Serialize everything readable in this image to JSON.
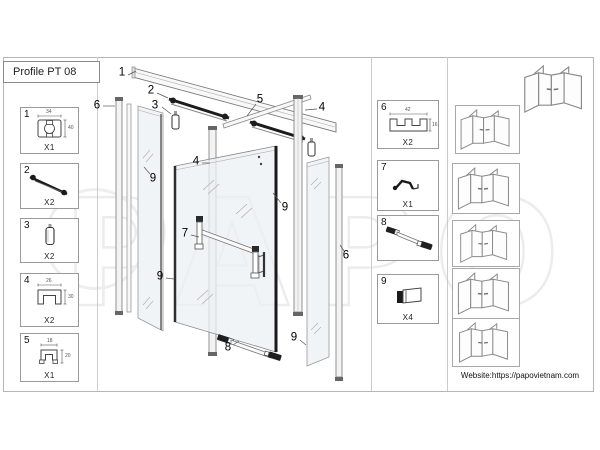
{
  "title": "Profile PT 08",
  "website": "Website:https://papovietnam.com",
  "watermark": "PAPO",
  "left_parts": [
    {
      "num": "1",
      "qty": "X1",
      "dim_top": "34",
      "dim_side": "40"
    },
    {
      "num": "2",
      "qty": "X2"
    },
    {
      "num": "3",
      "qty": "X2"
    },
    {
      "num": "4",
      "qty": "X2",
      "dim_top": "26",
      "dim_side": "30"
    },
    {
      "num": "5",
      "qty": "X1",
      "dim_top": "18",
      "dim_side": "20"
    }
  ],
  "right_parts": [
    {
      "num": "6",
      "qty": "X2",
      "dim_top": "42",
      "dim_side": "16"
    },
    {
      "num": "7",
      "qty": "X1"
    },
    {
      "num": "8",
      "qty": ""
    },
    {
      "num": "9",
      "qty": "X4"
    }
  ],
  "callouts": [
    {
      "label": "1"
    },
    {
      "label": "2"
    },
    {
      "label": "3"
    },
    {
      "label": "6"
    },
    {
      "label": "5"
    },
    {
      "label": "4"
    },
    {
      "label": "4"
    },
    {
      "label": "9"
    },
    {
      "label": "9"
    },
    {
      "label": "7"
    },
    {
      "label": "9"
    },
    {
      "label": "8"
    },
    {
      "label": "9"
    },
    {
      "label": "6"
    }
  ]
}
